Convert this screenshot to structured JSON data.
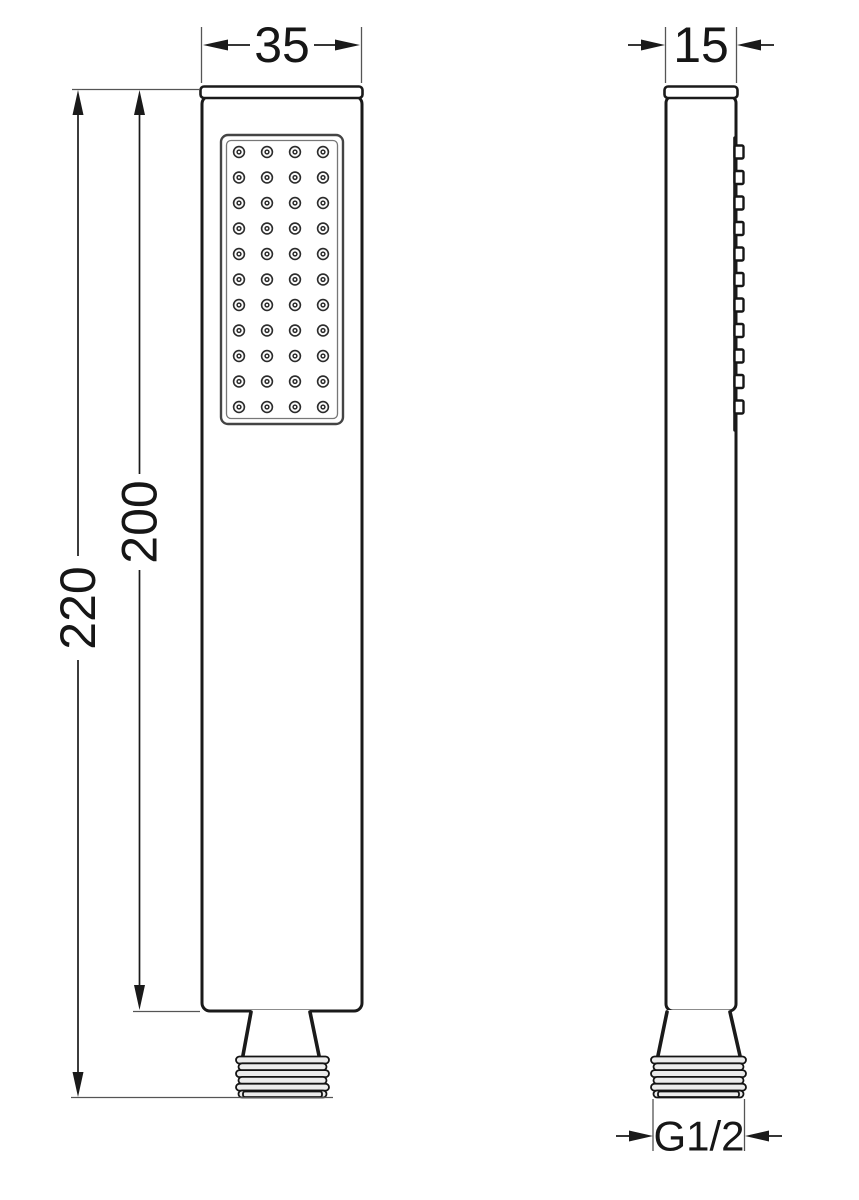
{
  "dimensions": {
    "front_width": "35",
    "side_width": "15",
    "total_height": "220",
    "body_height": "200",
    "thread_size": "G1/2"
  },
  "drawing": {
    "nozzle_rows": 11,
    "nozzle_cols": 4,
    "side_bumps": 11,
    "thread_ridges": 6,
    "colors": {
      "outline": "#1a1a1a",
      "dim_line": "#1a1a1a",
      "ext_line": "#555555",
      "body_fill": "#ffffff",
      "thread_fill": "#ececec"
    }
  }
}
